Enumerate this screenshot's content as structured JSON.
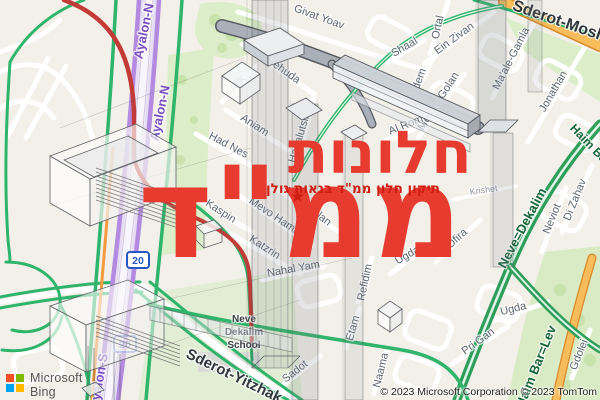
{
  "watermark": {
    "line1": "חלונות",
    "line2": "ממ\"ד",
    "subtitle": "תיקון חלון ממ\"ד בנאות גולן",
    "star": "★",
    "color_primary": "#e63b2e",
    "color_subtitle": "#cf1d14"
  },
  "attribution": {
    "copyright": "© 2023 Microsoft Corporation © 2023 TomTom",
    "logo_brand": "Microsoft",
    "logo_product": "Bing",
    "logo_colors": [
      "#f25022",
      "#7fba00",
      "#00a4ef",
      "#ffb900"
    ]
  },
  "map": {
    "palette": {
      "route_green": "#2fb46b",
      "highway_purple": "#b48ae0",
      "road_orange": "#f8bc5a",
      "route_red": "#c23b38",
      "park_green": "#dcedc9",
      "shield_blue": "#2456c4",
      "label_street": "#5b6570",
      "label_major": "#30363c",
      "label_highway": "#7a4fc0",
      "label_green_road": "#17663a"
    },
    "route_shields": [
      {
        "label": "20",
        "x": 138,
        "y": 260,
        "opacity": 1
      },
      {
        "label": "20",
        "x": 125,
        "y": 344,
        "opacity": 0.45
      }
    ],
    "labels": [
      {
        "t": "Ayalon-N",
        "x": 148,
        "y": 32,
        "r": -78,
        "s": 13,
        "c": "highway",
        "w": 700
      },
      {
        "t": "Ayalon-N",
        "x": 164,
        "y": 114,
        "r": -78,
        "s": 13,
        "c": "highway",
        "w": 700
      },
      {
        "t": "Ayalon-S",
        "x": 103,
        "y": 382,
        "r": -80,
        "s": 13,
        "c": "highway",
        "w": 700
      },
      {
        "t": "Givat Yoav",
        "x": 318,
        "y": 20,
        "r": 20,
        "s": 11,
        "c": "street"
      },
      {
        "t": "Ortal",
        "x": 441,
        "y": 28,
        "r": -78,
        "s": 11,
        "c": "street"
      },
      {
        "t": "Ein Zivan",
        "x": 456,
        "y": 41,
        "r": -36,
        "s": 11,
        "c": "street"
      },
      {
        "t": "Shaal",
        "x": 406,
        "y": 50,
        "r": -30,
        "s": 11,
        "c": "street"
      },
      {
        "t": "Odem",
        "x": 421,
        "y": 84,
        "r": -70,
        "s": 11,
        "c": "street"
      },
      {
        "t": "Merom Golan",
        "x": 441,
        "y": 103,
        "r": -57,
        "s": 11,
        "c": "street"
      },
      {
        "t": "Al Rom",
        "x": 407,
        "y": 128,
        "r": -22,
        "s": 11,
        "c": "street"
      },
      {
        "t": "Ma'ale-Gamla",
        "x": 514,
        "y": 60,
        "r": -63,
        "s": 11,
        "c": "street"
      },
      {
        "t": "Jonathan",
        "x": 556,
        "y": 93,
        "r": -60,
        "s": 11,
        "c": "street"
      },
      {
        "t": "Sderot-Moshe",
        "x": 562,
        "y": 27,
        "r": 19,
        "s": 16,
        "c": "major",
        "w": 700
      },
      {
        "t": "Haim Ba",
        "x": 586,
        "y": 146,
        "r": 46,
        "s": 12,
        "c": "green_road",
        "w": 700
      },
      {
        "t": "Di Zahav",
        "x": 578,
        "y": 201,
        "r": -68,
        "s": 11,
        "c": "street"
      },
      {
        "t": "Neviot",
        "x": 555,
        "y": 220,
        "r": -68,
        "s": 11,
        "c": "street"
      },
      {
        "t": "Neve=Dekalim",
        "x": 526,
        "y": 230,
        "r": -62,
        "s": 13,
        "c": "green_road",
        "w": 700
      },
      {
        "t": "Ofira",
        "x": 459,
        "y": 241,
        "r": -42,
        "s": 11,
        "c": "street"
      },
      {
        "t": "Ugda",
        "x": 409,
        "y": 258,
        "r": -30,
        "s": 11,
        "c": "street"
      },
      {
        "t": "Krishet",
        "x": 484,
        "y": 193,
        "r": -8,
        "s": 9,
        "c": "minor"
      },
      {
        "t": "Ugda",
        "x": 514,
        "y": 312,
        "r": -14,
        "s": 11,
        "c": "street"
      },
      {
        "t": "Pri Gan",
        "x": 480,
        "y": 344,
        "r": -36,
        "s": 11,
        "c": "street"
      },
      {
        "t": "Haim Bar=Lev",
        "x": 540,
        "y": 368,
        "r": -68,
        "s": 13,
        "c": "green_road",
        "w": 700
      },
      {
        "t": "Gdolei",
        "x": 582,
        "y": 356,
        "r": -68,
        "s": 11,
        "c": "street"
      },
      {
        "t": "Refidim",
        "x": 368,
        "y": 283,
        "r": -78,
        "s": 11,
        "c": "street"
      },
      {
        "t": "Etam",
        "x": 356,
        "y": 329,
        "r": -74,
        "s": 11,
        "c": "street"
      },
      {
        "t": "Naama",
        "x": 384,
        "y": 371,
        "r": -76,
        "s": 11,
        "c": "street"
      },
      {
        "t": "Nahal Yam",
        "x": 294,
        "y": 272,
        "r": -10,
        "s": 11,
        "c": "street"
      },
      {
        "t": "Sadot",
        "x": 297,
        "y": 374,
        "r": -38,
        "s": 11,
        "c": "street"
      },
      {
        "t": "Neve",
        "x": 244,
        "y": 322,
        "r": 0,
        "s": 10,
        "c": "place",
        "w": 600
      },
      {
        "t": "Dekalim",
        "x": 244,
        "y": 335,
        "r": 0,
        "s": 10,
        "c": "place",
        "w": 600
      },
      {
        "t": "School",
        "x": 244,
        "y": 348,
        "r": 0,
        "s": 10,
        "c": "place",
        "w": 600
      },
      {
        "t": "Sderot-Yitzhak",
        "x": 232,
        "y": 380,
        "r": 26,
        "s": 15,
        "c": "major",
        "w": 700
      },
      {
        "t": "Had Nes",
        "x": 227,
        "y": 148,
        "r": 28,
        "s": 11,
        "c": "street"
      },
      {
        "t": "Aniam",
        "x": 253,
        "y": 128,
        "r": 33,
        "s": 11,
        "c": "street"
      },
      {
        "t": "Bnei Yehuda",
        "x": 272,
        "y": 66,
        "r": 35,
        "s": 11,
        "c": "street"
      },
      {
        "t": "Afik",
        "x": 240,
        "y": 86,
        "r": -50,
        "s": 11,
        "c": "street"
      },
      {
        "t": "Hahalutsim",
        "x": 303,
        "y": 137,
        "r": -73,
        "s": 11,
        "c": "street"
      },
      {
        "t": "Mevo Hama",
        "x": 273,
        "y": 219,
        "r": 34,
        "s": 11,
        "c": "street"
      },
      {
        "t": "Neot Golan",
        "x": 306,
        "y": 209,
        "r": 38,
        "s": 11,
        "c": "street"
      },
      {
        "t": "Katzrin",
        "x": 263,
        "y": 250,
        "r": 33,
        "s": 11,
        "c": "street"
      },
      {
        "t": "Kaspin",
        "x": 219,
        "y": 214,
        "r": 33,
        "s": 11,
        "c": "street"
      }
    ]
  }
}
